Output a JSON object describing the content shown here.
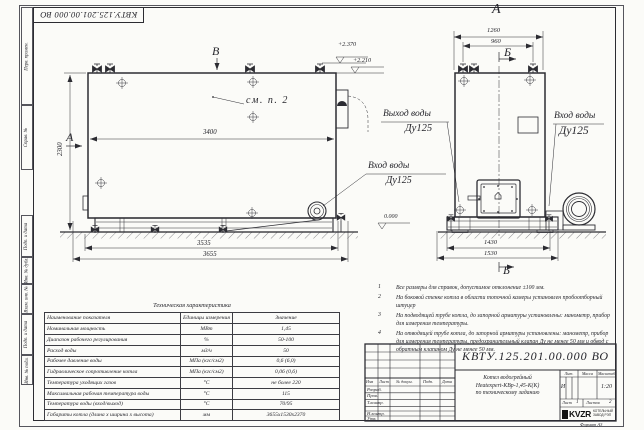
{
  "sheet": {
    "top_designation": "КВТУ.125.201.00.000  ВО",
    "format_label": "Формат  А3",
    "side_strip": [
      "Перв. примен.",
      "Справ. №",
      "Подп. и дата",
      "Инв. № дубл.",
      "Взам. инв. №",
      "Подп. и дата",
      "Инв. № подл."
    ]
  },
  "side_view": {
    "section_top": "В",
    "section_left": "А",
    "see_note": "см. п. 2",
    "dim_width": "3400",
    "dim_height": "2300",
    "dim_base_inner": "3535",
    "dim_base_outer": "3655",
    "elev_top1": "+2.370",
    "elev_top2": "+2.210",
    "elev_zero": "0.000",
    "inlet_line1": "Вход воды",
    "inlet_line2": "Ду125"
  },
  "front_view": {
    "view_title": "А",
    "dim_top_outer": "1260",
    "dim_top_inner": "960",
    "section_mark_top": "Б",
    "section_mark_bottom": "Б",
    "outlet_line1": "Выход воды",
    "outlet_line2": "Ду125",
    "inlet_line1": "Вход воды",
    "inlet_line2": "Ду125",
    "dim_base_inner": "1430",
    "dim_base_outer": "1530"
  },
  "notes": {
    "items": [
      {
        "num": "1",
        "text": "Все размеры для справок, допустимое отклонение ±100 мм."
      },
      {
        "num": "2",
        "text": "На боковой стенке котла в области топочной камеры установлен пробоотборный штуцер"
      },
      {
        "num": "3",
        "text": "На подводящей трубе котла, до запорной арматуры установлены: манометр, прибор для измерения температуры."
      },
      {
        "num": "4",
        "text": "На отводящей трубе котла, до запорной арматуры установлены: манометр, прибор для измерения температуры, предохранительный клапан Ду не менее 50 мм и обвод с обратным клапаном Ду не менее 50 мм."
      }
    ]
  },
  "tech_table": {
    "title": "Техническая характеристика",
    "col_name": "Наименование показателя",
    "col_units": "Единицы измерения",
    "col_value": "Значение",
    "rows": [
      {
        "name": "Номинальная мощность",
        "units": "МВт",
        "value": "1,45"
      },
      {
        "name": "Диапазон рабочего регулирования",
        "units": "%",
        "value": "50-100"
      },
      {
        "name": "Расход воды",
        "units": "м3/ч",
        "value": "50"
      },
      {
        "name": "Рабочее давление воды",
        "units": "МПа (кгс/см2)",
        "value": "0,6 (6,0)"
      },
      {
        "name": "Гидравлическое сопротивление котла",
        "units": "МПа (кгс/см2)",
        "value": "0,06 (0,6)"
      },
      {
        "name": "Температура уходящих газов",
        "units": "°С",
        "value": "не более 220"
      },
      {
        "name": "Максимальная рабочая температура воды",
        "units": "°С",
        "value": "115"
      },
      {
        "name": "Температура воды (вход/выход)",
        "units": "°С",
        "value": "70/95"
      },
      {
        "name": "Габариты котла (длина х ширина х высота)",
        "units": "мм",
        "value": "3655х1530х2370"
      }
    ]
  },
  "title_block": {
    "designation": "КВТУ.125.201.00.000  ВО",
    "header_cells": [
      "Изм",
      "Лист",
      "№ докум.",
      "Подп.",
      "Дата"
    ],
    "row_labels": [
      "Разраб.",
      "Пров.",
      "Т.контр.",
      "Н.контр.",
      "Утв."
    ],
    "product_line1": "Котел водогрейный",
    "product_line2": "Heatexpert-КВр-1,45-К(К)",
    "product_line3": "по техническому заданию",
    "lit_header": "Лит.",
    "mass_header": "Масса",
    "scale_header": "Масштаб",
    "lit_value": "И",
    "scale_value": "1:20",
    "sheet_label": "Лист",
    "sheet_value": "1",
    "sheets_label": "Листов",
    "sheets_value": "2",
    "logo_text": "KVZR",
    "logo_sub1": "КОТЕЛЬНЫЙ",
    "logo_sub2": "ЗАВОД РЭП"
  }
}
